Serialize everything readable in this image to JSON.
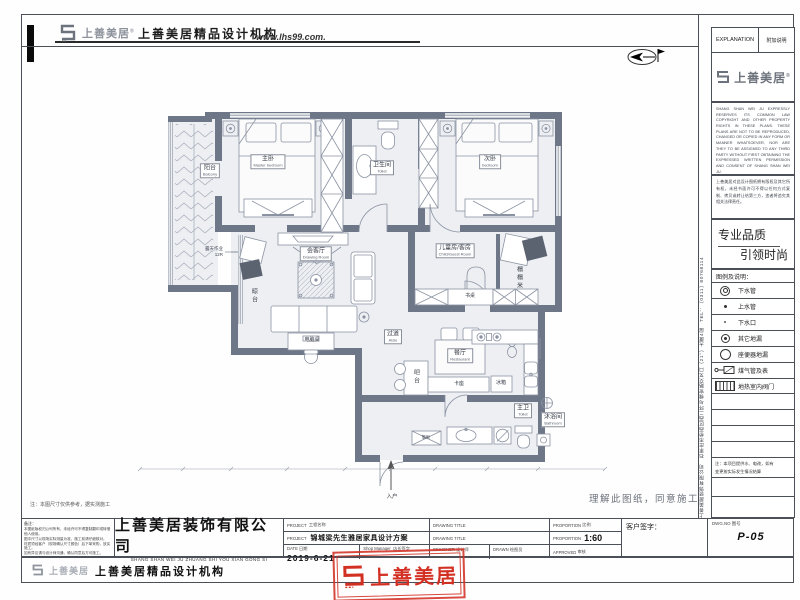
{
  "header": {
    "brand": "上善美居",
    "reg": "®",
    "agency": "上善美居精品设计机构",
    "website": "www.lhs99.com."
  },
  "sidebar": {
    "explanation_en": "EXPLANATION",
    "explanation_cn": "附加说明",
    "brand": "上善美居",
    "legal_en": "SHANG SHAN WEI JU EXPRESSLY RESERVES ITS COMMON LAW COPYRIGHT AND OTHER PROPERTY RIGHTS IN THESE PLANS. THESE PLANS ARE NOT TO BE REPRODUCED, CHANGED OR COPIED IN ANY FORM OR MANNER WHATSOEVER, NOR ARE THEY TO BE ASSIGNED TO ANY THIRD PARTY WITHOUT FIRST OBTAINING THE EXPRESSED WRITTEN PERMISSION AND CONSENT OF SHANG SHAN WEI JU.",
    "legal_cn": "上善美居对此设计图纸拥有版权及其它所有权，未经书面许可不得以任何方式复制、拷贝或转让给第三方，违者将追究其相关法律责任。",
    "slogan_top": "专业品质",
    "slogan_bottom": "引领时尚",
    "legend_title": "图例及说明：",
    "legend": [
      "下水管",
      "上水管",
      "下水口",
      "其它地漏",
      "座便器地漏",
      "煤气管及表",
      "地热室内阀门"
    ],
    "note_line1": "注：本项目提供水、电改，如有",
    "note_line2": "变更按实际发生情况结算",
    "side_text": "上善美居装饰有限公司　石家庄市桥西区西二环与槐安路交叉口（21°）大厦4层　TEL：（0311）80768114"
  },
  "plan": {
    "rooms": [
      {
        "cn": "阳台",
        "en": "Balcony"
      },
      {
        "cn": "主卧",
        "en": "Master bedroom"
      },
      {
        "cn": "卫生间",
        "en": "Toilet"
      },
      {
        "cn": "次卧",
        "en": "bedroom"
      },
      {
        "cn": "晾台",
        "en": ""
      },
      {
        "cn": "会客厅",
        "en": "Drawing Room"
      },
      {
        "cn": "电脑桌",
        "en": ""
      },
      {
        "cn": "儿童房/客房",
        "en": "Child/Guest Room"
      },
      {
        "cn": "榻榻米",
        "en": ""
      },
      {
        "cn": "书桌",
        "en": ""
      },
      {
        "cn": "过道",
        "en": "Aisle"
      },
      {
        "cn": "餐厅",
        "en": "Restaurant"
      },
      {
        "cn": "吧台",
        "en": ""
      },
      {
        "cn": "卡座",
        "en": ""
      },
      {
        "cn": "冰箱",
        "en": ""
      },
      {
        "cn": "主卫",
        "en": "Toilet"
      },
      {
        "cn": "沐浴间",
        "en": "Bathroom"
      },
      {
        "cn": "入户",
        "en": ""
      },
      {
        "cn": "鞋柜",
        "en": ""
      }
    ],
    "annotation": {
      "line1": "露天作业",
      "line2": "12R"
    },
    "agree_text": "理解此图纸，同意施工",
    "corner_note": "注：本图尺寸仅供参考，据实测施工"
  },
  "titleblock": {
    "remark_label": "备注：",
    "remarks": [
      "本图纸版权归公司所有，未经许可不得复制翻印或转借他人使用。",
      "图中尺寸以现场实际测量为准，施工前请仔细核对。",
      "材质须经客户（现场确认尺寸颜色）后下单采购，放实施工。",
      "如有异议请与设计师沟通，确认同意后方可施工。"
    ],
    "company_cn": "上善美居装饰有限公司",
    "company_py": "SHANG SHAN WEI JU ZHUANG SHI YOU XIAN GONG SI",
    "project_en": "PROJECT",
    "project_cn": "工程名称",
    "project_name": "锦城梁先生雅居家具设计方案",
    "date_en": "DATE",
    "date_cn": "日期",
    "date_value": "2019-6-21",
    "manager_en": "Shop Manager",
    "manager_cn": "店长签字",
    "dt_en": "DRAWING TITLE",
    "designer_en": "DESIGNER",
    "designer_cn": "设计师",
    "drawn_en": "DRAWN",
    "drawn_cn": "绘图员",
    "prop_en": "PROPORTION",
    "prop_cn": "比例",
    "prop_value": "1:60",
    "approved_en": "APPROVED",
    "approved_cn": "审核",
    "client_sign": "客户签字：",
    "dwg_en": "DWG.NO",
    "dwg_cn": "图号",
    "dwg_value": "P-05"
  },
  "footer": {
    "agency": "上善美居精品设计机构",
    "stamp_text": "上善美居"
  }
}
